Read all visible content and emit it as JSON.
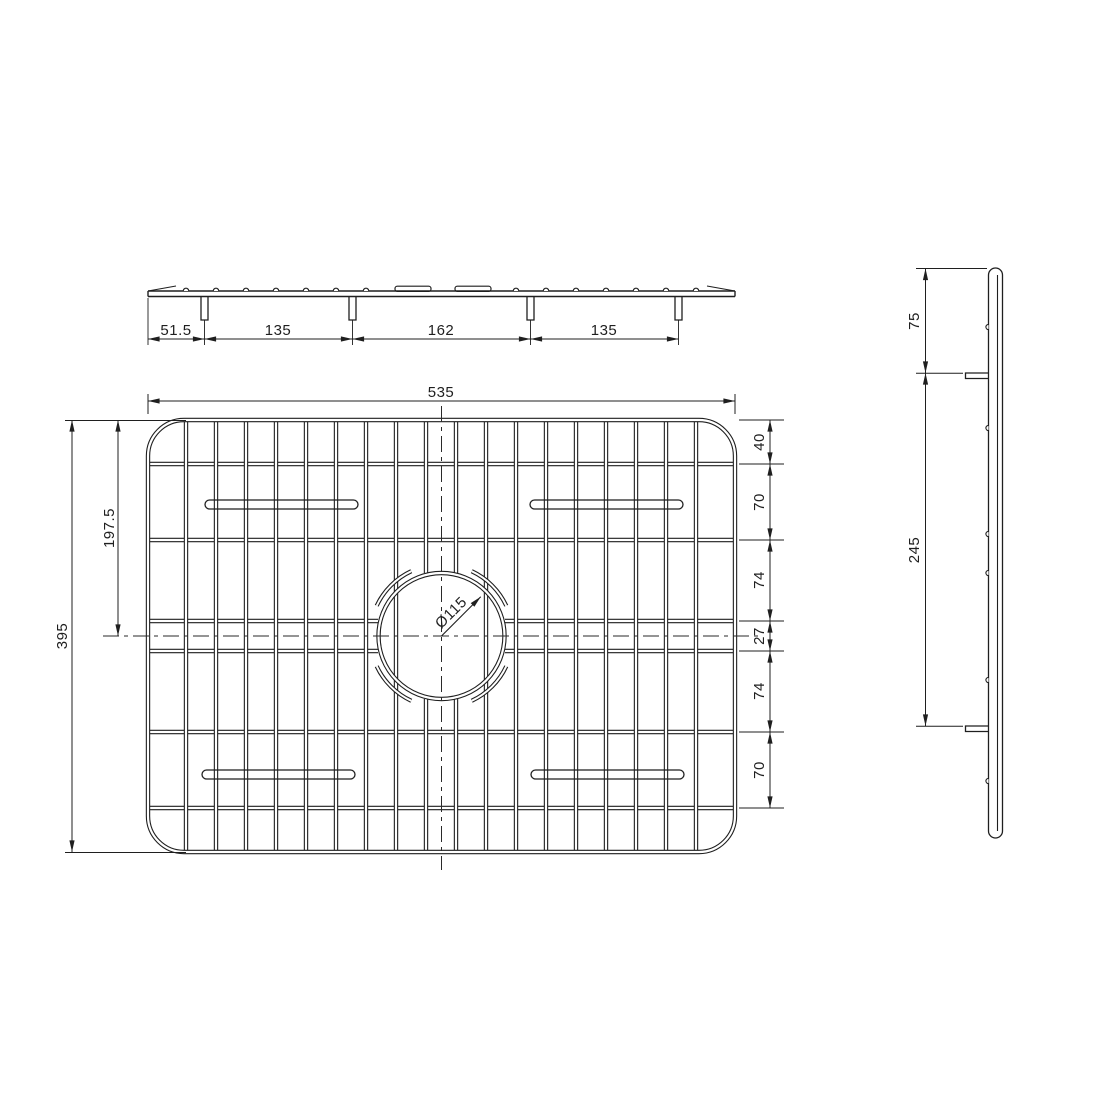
{
  "drawing": {
    "title": "sink-grid-technical-drawing",
    "colors": {
      "background": "#ffffff",
      "line": "#1f1f1f"
    },
    "top_view": {
      "dims": {
        "left_offset": "51.5",
        "span1": "135",
        "span2": "162",
        "span3": "135"
      }
    },
    "plan_view": {
      "dims": {
        "width": "535",
        "height": "395",
        "center_from_top": "197.5",
        "hole_diameter": "Ø115",
        "chain": [
          "40",
          "70",
          "74",
          "27",
          "74",
          "70"
        ]
      }
    },
    "side_view": {
      "dims": {
        "top_to_foot": "75",
        "foot_to_foot": "245"
      }
    }
  }
}
